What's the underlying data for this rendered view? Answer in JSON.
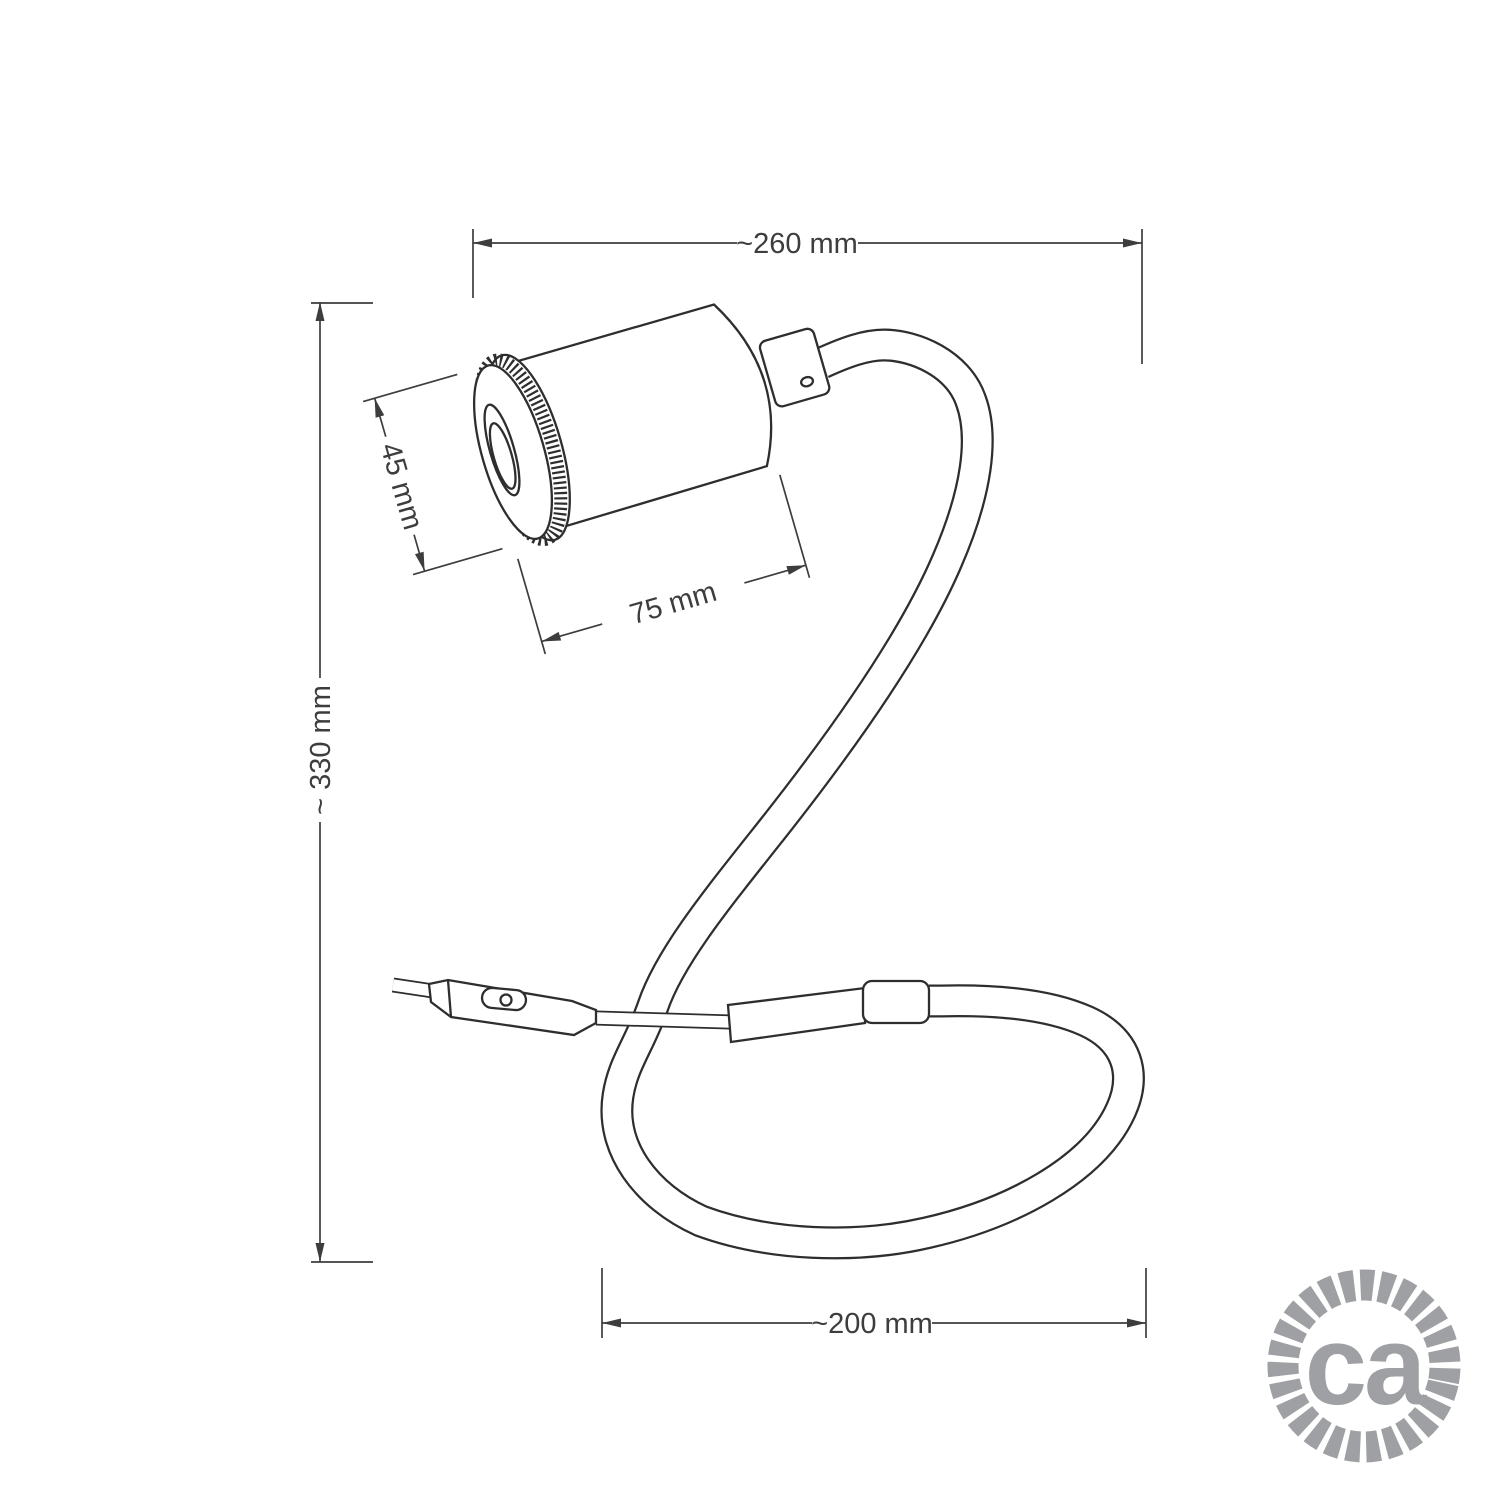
{
  "diagram": {
    "type": "technical-dimension-drawing",
    "subject": "flexible gooseneck spotlight table lamp",
    "line_color": "#2e2e2e",
    "dim_color": "#3d3d3d"
  },
  "dims": {
    "overall_width": {
      "label": "~260 mm"
    },
    "overall_height": {
      "label": "~ 330 mm"
    },
    "head_diameter": {
      "label": "45 mm"
    },
    "head_length": {
      "label": "75 mm"
    },
    "base_loop_width": {
      "label": "~200 mm"
    }
  },
  "logo": {
    "text": "ca",
    "color": "#9fa0a3"
  }
}
